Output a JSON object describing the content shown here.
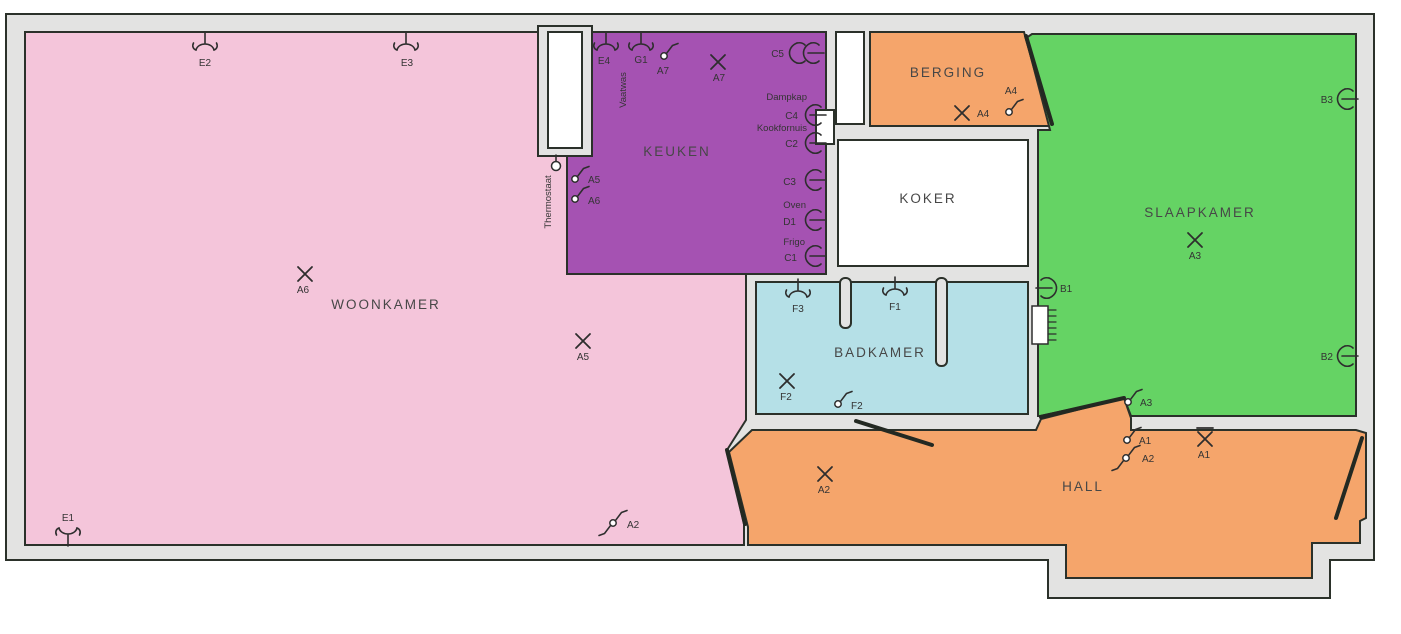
{
  "plan_title": "Apartment electrical floor plan",
  "colors": {
    "wall": "#e3e3e2",
    "outline": "#2b312a",
    "symbol": "#2e2e2e",
    "woonkamer": "#f4c5da",
    "keuken": "#a552b2",
    "berging": "#f5a56b",
    "hall": "#f5a56b",
    "koker": "#ffffff",
    "slaapkamer": "#65d364",
    "badkamer": "#b5e0e7",
    "shaft": "#ffffff"
  },
  "rooms": [
    {
      "id": "woonkamer",
      "name": "WOONKAMER"
    },
    {
      "id": "keuken",
      "name": "KEUKEN"
    },
    {
      "id": "berging",
      "name": "BERGING"
    },
    {
      "id": "koker",
      "name": "KOKER"
    },
    {
      "id": "slaapkamer",
      "name": "SLAAPKAMER"
    },
    {
      "id": "badkamer",
      "name": "BADKAMER"
    },
    {
      "id": "hall",
      "name": "HALL"
    }
  ],
  "devices": [
    {
      "id": "E2",
      "label": "E2",
      "type": "sconce",
      "x": 205,
      "y": 47,
      "lx": 205,
      "ly": 66
    },
    {
      "id": "E3",
      "label": "E3",
      "type": "sconce",
      "x": 406,
      "y": 47,
      "lx": 407,
      "ly": 66
    },
    {
      "id": "E1",
      "label": "E1",
      "type": "sconce",
      "rot": 180,
      "x": 68,
      "y": 531,
      "lx": 68,
      "ly": 521
    },
    {
      "id": "E4",
      "label": "E4",
      "type": "sconce",
      "x": 606,
      "y": 47,
      "lx": 604,
      "ly": 64
    },
    {
      "id": "G1",
      "label": "G1",
      "type": "sconce",
      "x": 641,
      "y": 47,
      "lx": 641,
      "ly": 63
    },
    {
      "id": "A7-switch",
      "label": "A7",
      "type": "switch",
      "x": 664,
      "y": 56,
      "lx": 663,
      "ly": 74
    },
    {
      "id": "A7-light",
      "label": "A7",
      "type": "light",
      "x": 718,
      "y": 62,
      "lx": 719,
      "ly": 81
    },
    {
      "id": "A6-light",
      "label": "A6",
      "type": "light",
      "x": 305,
      "y": 274,
      "lx": 303,
      "ly": 293
    },
    {
      "id": "A5-light",
      "label": "A5",
      "type": "light",
      "x": 583,
      "y": 341,
      "lx": 583,
      "ly": 360
    },
    {
      "id": "A2-switch-woonkamer",
      "label": "A2",
      "type": "switch",
      "two": true,
      "x": 613,
      "y": 523,
      "lx": 627,
      "ly": 528,
      "anchor": "start"
    },
    {
      "id": "A5-switch",
      "label": "A5",
      "type": "switch",
      "x": 575,
      "y": 179,
      "lx": 588,
      "ly": 183,
      "anchor": "start"
    },
    {
      "id": "A6-switch",
      "label": "A6",
      "type": "switch",
      "x": 575,
      "y": 199,
      "lx": 588,
      "ly": 204,
      "anchor": "start"
    },
    {
      "id": "C5",
      "label": "C5",
      "type": "socket",
      "double": true,
      "x": 808,
      "y": 53,
      "lx": 784,
      "ly": 57,
      "anchor": "end"
    },
    {
      "id": "C4",
      "label": "C4",
      "type": "socket",
      "x": 810,
      "y": 115,
      "lx": 798,
      "ly": 119,
      "anchor": "end"
    },
    {
      "id": "C2",
      "label": "C2",
      "type": "socket",
      "x": 810,
      "y": 143,
      "lx": 798,
      "ly": 147,
      "anchor": "end"
    },
    {
      "id": "C3",
      "label": "C3",
      "type": "socket",
      "x": 810,
      "y": 180,
      "lx": 796,
      "ly": 185,
      "anchor": "end"
    },
    {
      "id": "D1",
      "label": "D1",
      "type": "socket",
      "x": 810,
      "y": 220,
      "lx": 796,
      "ly": 225,
      "anchor": "end"
    },
    {
      "id": "C1",
      "label": "C1",
      "type": "socket",
      "x": 810,
      "y": 256,
      "lx": 797,
      "ly": 261,
      "anchor": "end"
    },
    {
      "id": "A4-light",
      "label": "A4",
      "type": "light",
      "x": 962,
      "y": 113,
      "lx": 977,
      "ly": 117,
      "anchor": "start"
    },
    {
      "id": "A4-switch",
      "label": "A4",
      "type": "switch",
      "x": 1009,
      "y": 112,
      "lx": 1011,
      "ly": 94
    },
    {
      "id": "A3-light",
      "label": "A3",
      "type": "light",
      "x": 1195,
      "y": 240,
      "lx": 1195,
      "ly": 259
    },
    {
      "id": "B3",
      "label": "B3",
      "type": "socket",
      "x": 1342,
      "y": 99,
      "lx": 1333,
      "ly": 103,
      "anchor": "end"
    },
    {
      "id": "B2",
      "label": "B2",
      "type": "socket",
      "x": 1342,
      "y": 356,
      "lx": 1333,
      "ly": 360,
      "anchor": "end"
    },
    {
      "id": "B1",
      "label": "B1",
      "type": "socket",
      "dir": "left",
      "x": 1052,
      "y": 288,
      "lx": 1060,
      "ly": 292,
      "anchor": "start"
    },
    {
      "id": "A3-switch",
      "label": "A3",
      "type": "switch",
      "x": 1128,
      "y": 402,
      "lx": 1140,
      "ly": 406,
      "anchor": "start"
    },
    {
      "id": "F3",
      "label": "F3",
      "type": "sconce",
      "x": 798,
      "y": 294,
      "lx": 798,
      "ly": 312
    },
    {
      "id": "F1",
      "label": "F1",
      "type": "sconce",
      "x": 895,
      "y": 292,
      "lx": 895,
      "ly": 310
    },
    {
      "id": "F2-light",
      "label": "F2",
      "type": "light",
      "x": 787,
      "y": 381,
      "lx": 786,
      "ly": 400
    },
    {
      "id": "F2-switch",
      "label": "F2",
      "type": "switch",
      "x": 838,
      "y": 404,
      "lx": 851,
      "ly": 409,
      "anchor": "start"
    },
    {
      "id": "A2-light-hall",
      "label": "A2",
      "type": "light",
      "x": 825,
      "y": 474,
      "lx": 824,
      "ly": 493
    },
    {
      "id": "A1-switch",
      "label": "A1",
      "type": "switch",
      "x": 1127,
      "y": 440,
      "lx": 1139,
      "ly": 444,
      "anchor": "start"
    },
    {
      "id": "A2-switch-hall",
      "label": "A2",
      "type": "switch",
      "two": true,
      "x": 1126,
      "y": 458,
      "lx": 1142,
      "ly": 462,
      "anchor": "start"
    },
    {
      "id": "A1-wall-light",
      "label": "A1",
      "type": "light-bar",
      "x": 1205,
      "y": 439,
      "lx": 1204,
      "ly": 458
    },
    {
      "id": "thermostat",
      "label": "",
      "type": "thermostat",
      "x": 556,
      "y": 166
    },
    {
      "id": "heating-panel",
      "label": "",
      "type": "panel",
      "x": 1032,
      "y": 306
    }
  ],
  "annotations": [
    {
      "text": "Thermostaat",
      "x": 551,
      "y": 202,
      "rotate": -90
    },
    {
      "text": "Vaatwas",
      "x": 626,
      "y": 90,
      "rotate": -90
    },
    {
      "text": "Dampkap",
      "x": 807,
      "y": 100,
      "anchor": "end"
    },
    {
      "text": "Kookfornuis",
      "x": 807,
      "y": 131,
      "anchor": "end"
    },
    {
      "text": "Oven",
      "x": 806,
      "y": 208,
      "anchor": "end"
    },
    {
      "text": "Frigo",
      "x": 805,
      "y": 245,
      "anchor": "end"
    }
  ]
}
